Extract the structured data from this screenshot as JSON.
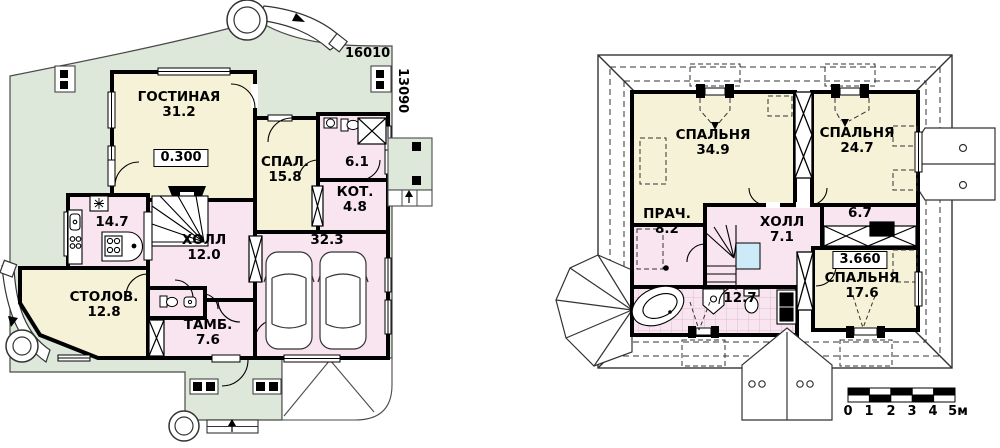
{
  "drawing_title": "Two-storey house floor plans",
  "colors": {
    "plot_green": "#dde8db",
    "room_cream": "#f6f2d7",
    "room_pink": "#f8e5f0",
    "stair_landing_blue": "#cdeaf8",
    "wall_black": "#000000",
    "roof_white": "#ffffff"
  },
  "floor1": {
    "rooms": [
      {
        "name": "ГОСТИНАЯ",
        "area": "31.2"
      },
      {
        "name": "СПАЛ.",
        "area": "15.8"
      },
      {
        "name": "",
        "area": "6.1"
      },
      {
        "name": "КОТ.",
        "area": "4.8"
      },
      {
        "name": "",
        "area": "14.7"
      },
      {
        "name": "ХОЛЛ",
        "area": "12.0"
      },
      {
        "name": "СТОЛОВ.",
        "area": "12.8"
      },
      {
        "name": "ТАМБ.",
        "area": "7.6"
      },
      {
        "name": "",
        "area": "32.3"
      }
    ],
    "elevation": "0.300",
    "dim_width": "16010",
    "dim_height": "13090"
  },
  "floor2": {
    "rooms": [
      {
        "name": "СПАЛЬНЯ",
        "area": "34.9"
      },
      {
        "name": "СПАЛЬНЯ",
        "area": "24.7"
      },
      {
        "name": "ПРАЧ.",
        "area": "8.2"
      },
      {
        "name": "ХОЛЛ",
        "area": "7.1"
      },
      {
        "name": "",
        "area": "6.7"
      },
      {
        "name": "СПАЛЬНЯ",
        "area": "17.6"
      },
      {
        "name": "",
        "area": "12.7"
      }
    ],
    "elevation": "3.660"
  },
  "scale_bar": {
    "labels": [
      "0",
      "1",
      "2",
      "3",
      "4",
      "5м"
    ]
  }
}
